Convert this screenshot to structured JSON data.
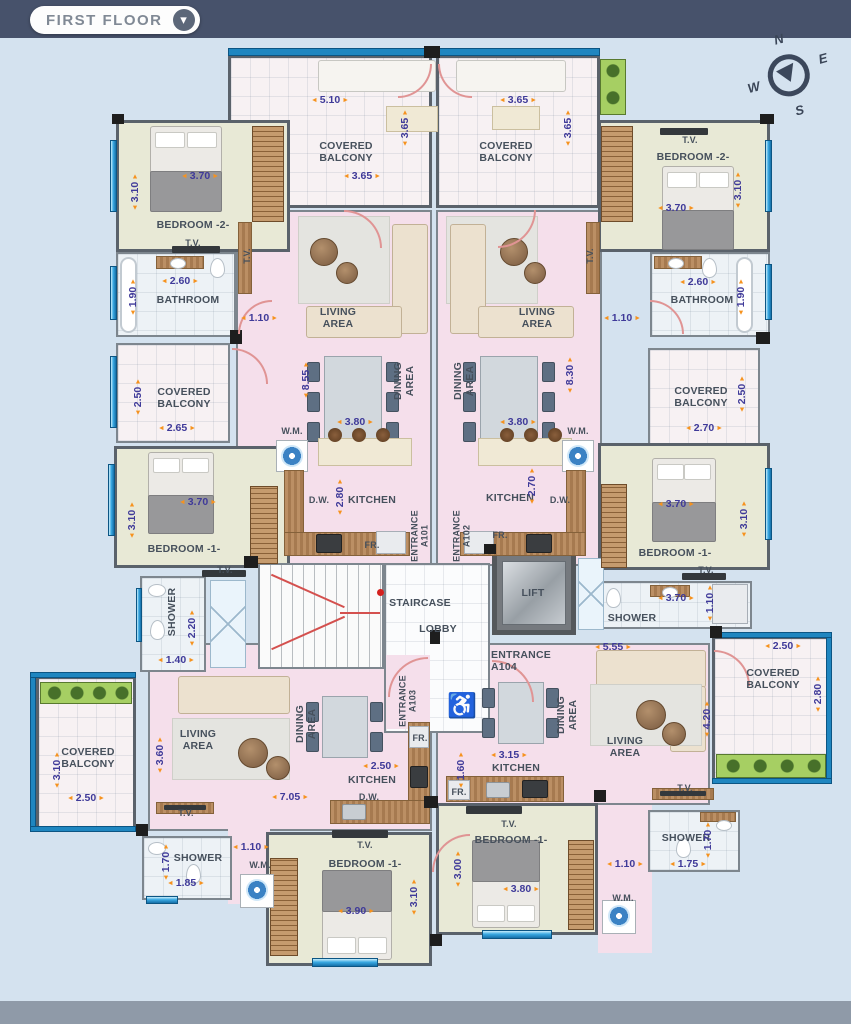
{
  "header": {
    "title": "FIRST FLOOR"
  },
  "compass": {
    "n": "N",
    "e": "E",
    "s": "S",
    "w": "W"
  },
  "labels": {
    "covered_balcony": "COVERED BALCONY",
    "living_area": "LIVING AREA",
    "dining_area": "DINING AREA",
    "kitchen": "KITCHEN",
    "bathroom": "BATHROOM",
    "shower": "SHOWER",
    "bedroom1": "BEDROOM -1-",
    "bedroom2": "BEDROOM -2-",
    "staircase": "STAIRCASE",
    "lobby": "LOBBY",
    "lift": "LIFT",
    "entrance_a101": "ENTRANCE A101",
    "entrance_a102": "ENTRANCE A102",
    "entrance_a103": "ENTRANCE A103",
    "entrance_a104": "ENTRANCE A104",
    "tv": "T.V.",
    "wm": "W.M.",
    "dw": "D.W.",
    "fr": "FR."
  },
  "dims": {
    "bt_l_w": "5.10",
    "bt_l_h": "3.65",
    "bt_l_w2": "3.65",
    "bt_r_w": "3.65",
    "bt_r_h": "3.65",
    "b2l_w": "3.70",
    "b2l_h": "3.10",
    "b2r_w": "3.70",
    "b2r_h": "3.10",
    "ba_l_w": "2.60",
    "ba_l_h": "1.90",
    "ba_r_w": "2.60",
    "ba_r_h": "1.90",
    "hall_l": "1.10",
    "hall_r": "1.10",
    "lv_l_h": "8.55",
    "lv_r_h": "8.30",
    "dn_l_w": "3.80",
    "dn_r_w": "3.80",
    "kt_l_h": "2.80",
    "kt_r_h": "2.70",
    "bm_l_h": "2.50",
    "bm_l_w": "2.65",
    "bm_r_w": "2.70",
    "bm_r_h": "2.50",
    "b1ml_w": "3.70",
    "b1ml_h": "3.10",
    "b1mr_w": "3.70",
    "b1mr_h": "3.10",
    "sh_ml_h": "2.20",
    "sh_ml_w": "1.40",
    "sh_mr_w": "3.70",
    "sh_mr_h": "1.10",
    "lv_br_w": "5.55",
    "bb_r_w": "2.50",
    "bb_r_h": "2.80",
    "bb_l_h": "3.10",
    "bb_l_w": "2.50",
    "lv_bl_h": "3.60",
    "lv_bl_w": "7.05",
    "kt_bl_w": "2.50",
    "kt_br_w": "3.15",
    "kt_br_h": "1.60",
    "lv_br_h": "4.20",
    "hall_bl": "1.10",
    "sh_bl_h": "1.70",
    "sh_bl_w": "1.85",
    "b1bl_w": "3.90",
    "b1bl_h": "3.10",
    "b1br_h": "3.00",
    "b1br_w": "3.80",
    "hall_br": "1.10",
    "sh_br_w": "1.75",
    "sh_br_h": "1.70"
  },
  "colors": {
    "bg": "#d4e2ef",
    "bar": "#47526b",
    "pink": "#f5dfeb",
    "olive": "#e8e9d6",
    "tile": "#edf2f6",
    "orange": "#f6921e",
    "dimtext": "#3f3a99",
    "green": "#a6cf63",
    "blue": "#2f9fd8"
  }
}
